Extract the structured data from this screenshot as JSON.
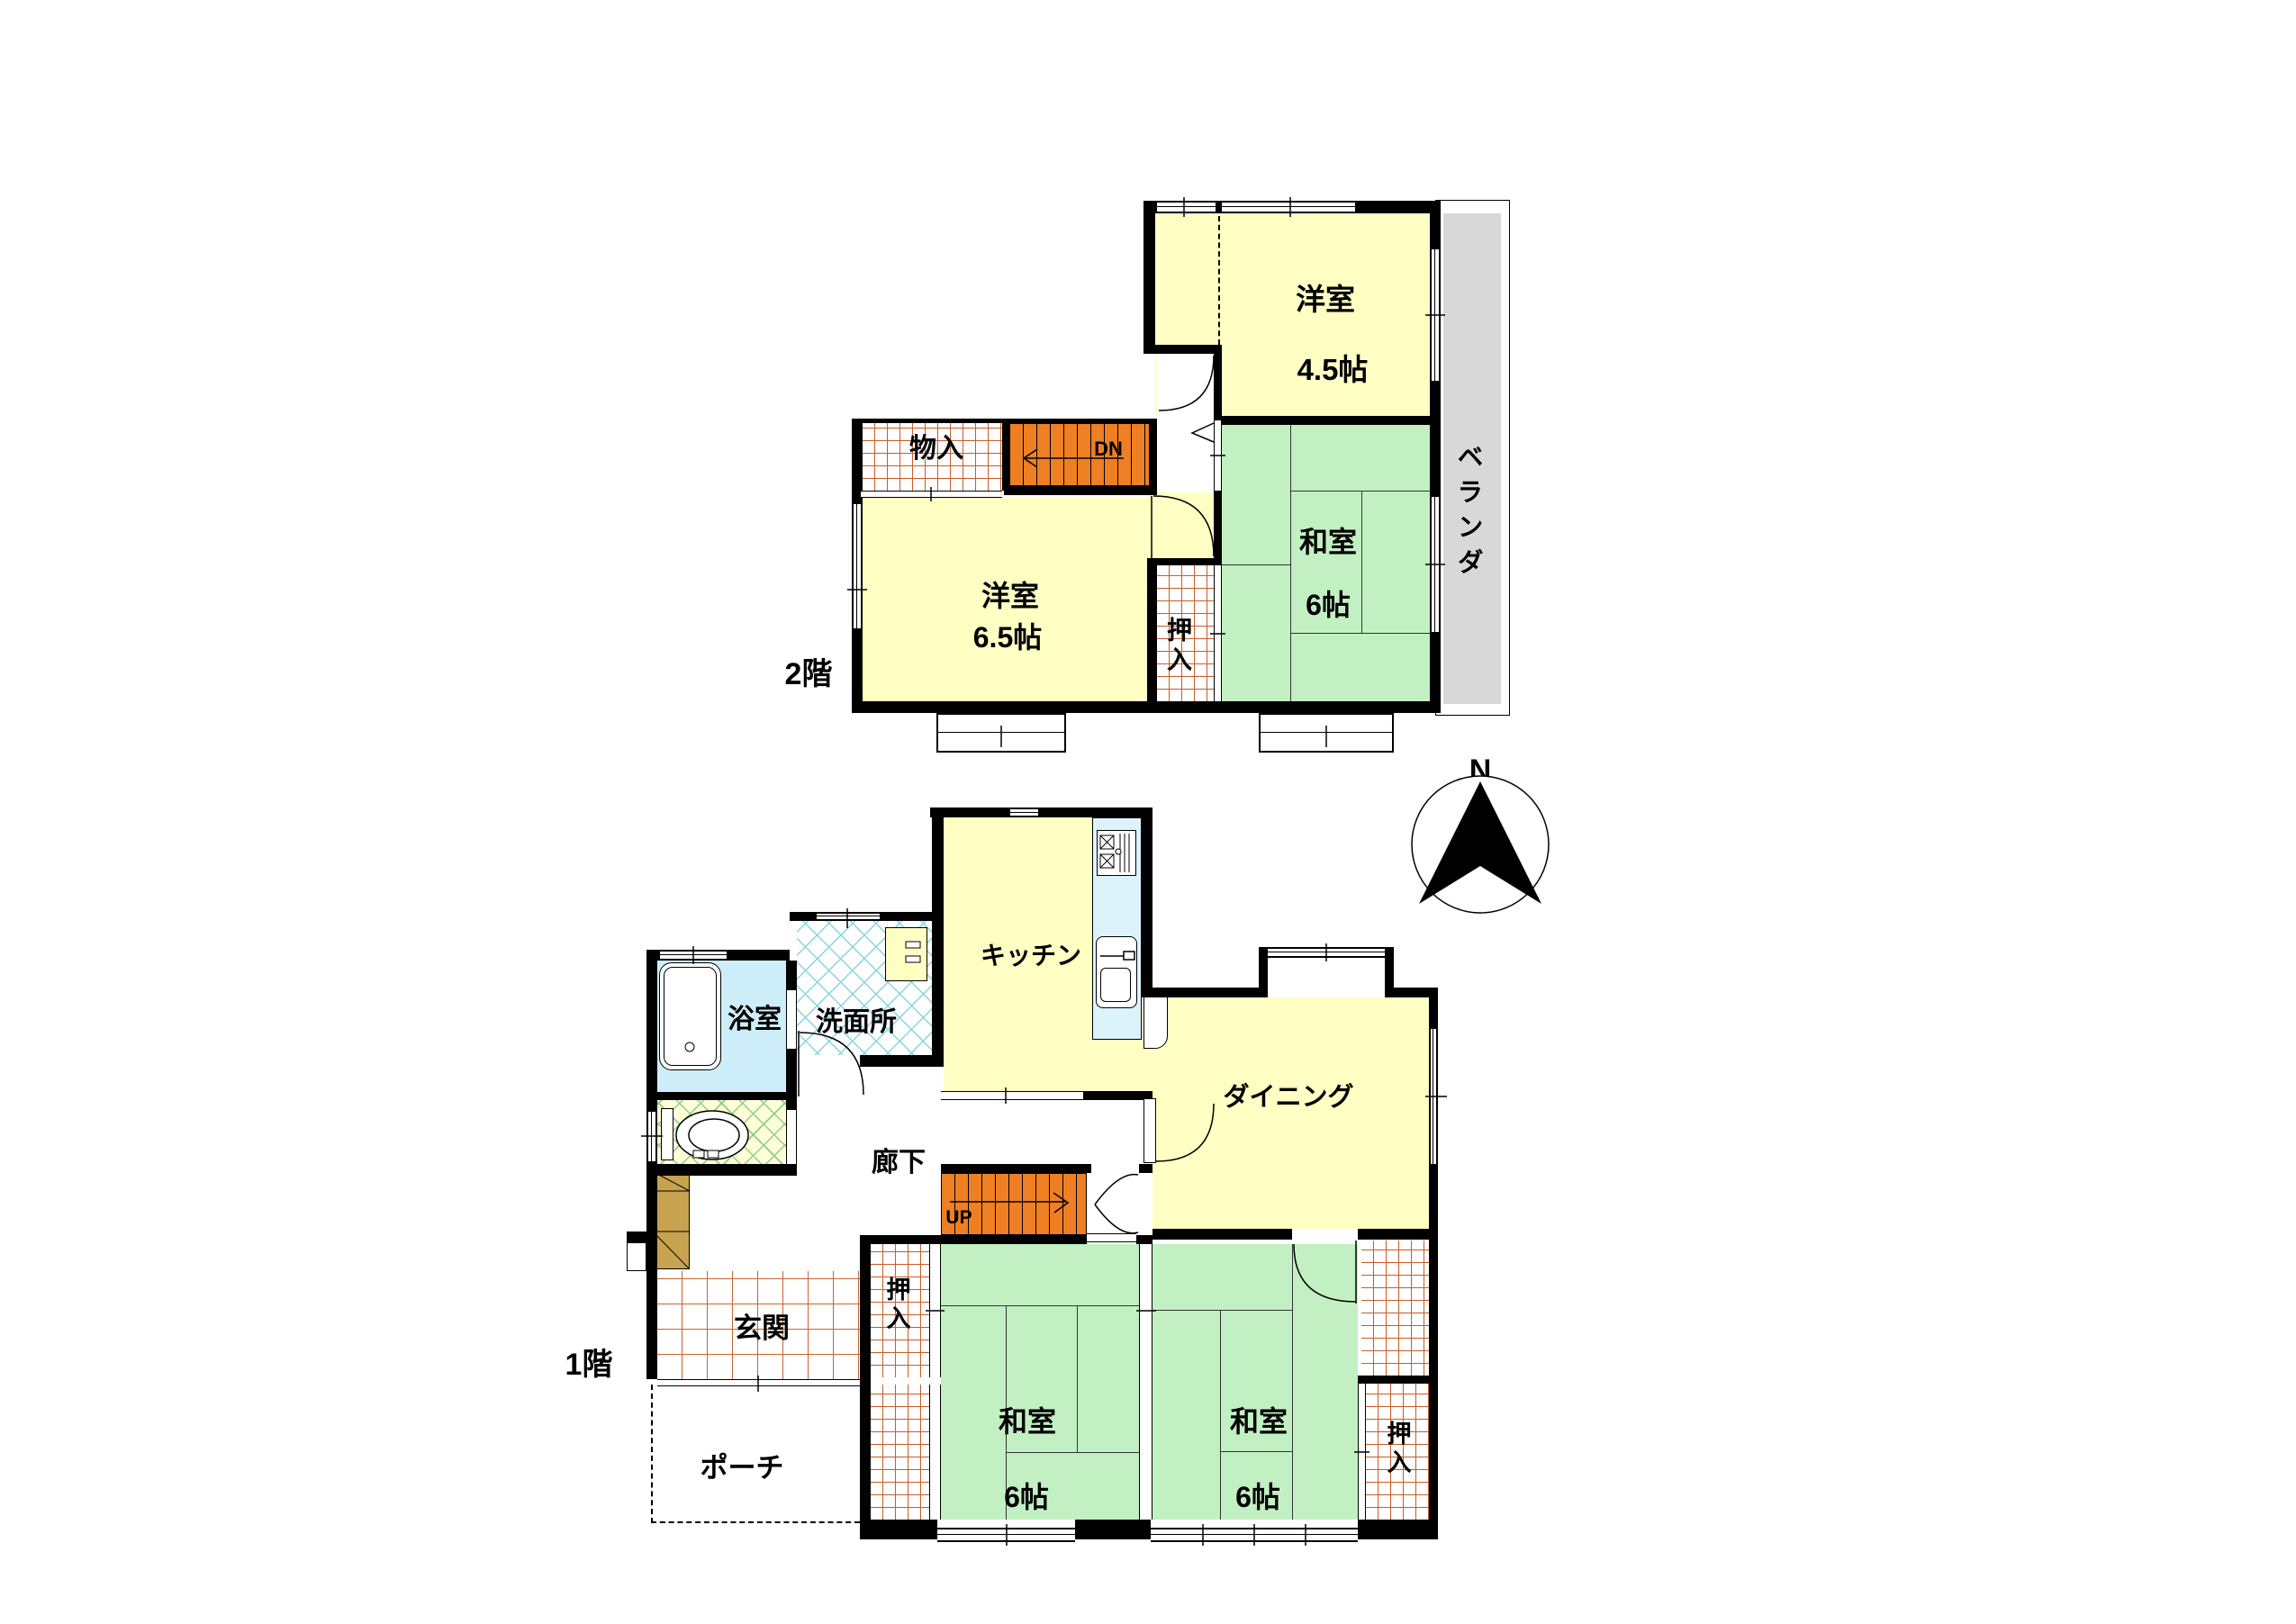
{
  "floor2": {
    "title": "2階",
    "rooms": {
      "western45": {
        "name": "洋室",
        "size": "4.5帖"
      },
      "japanese6": {
        "name": "和室",
        "size": "6帖"
      },
      "western65": {
        "name": "洋室",
        "size": "6.5帖"
      },
      "storage": {
        "name": "物入"
      },
      "closet": {
        "name": "押入"
      },
      "veranda": {
        "name": "ベランダ"
      },
      "stairs_down": {
        "label": "DN"
      }
    }
  },
  "floor1": {
    "title": "1階",
    "rooms": {
      "kitchen": {
        "name": "キッチン"
      },
      "dining": {
        "name": "ダイニング"
      },
      "bath": {
        "name": "浴室"
      },
      "washroom": {
        "name": "洗面所"
      },
      "corridor": {
        "name": "廊下"
      },
      "entrance": {
        "name": "玄関"
      },
      "porch": {
        "name": "ポーチ"
      },
      "closet_left": {
        "name": "押入"
      },
      "closet_right": {
        "name": "押入"
      },
      "japanese_left": {
        "name": "和室",
        "size": "6帖"
      },
      "japanese_right": {
        "name": "和室",
        "size": "6帖"
      },
      "stairs_up": {
        "label": "UP"
      }
    }
  },
  "compass": {
    "north": "N"
  }
}
